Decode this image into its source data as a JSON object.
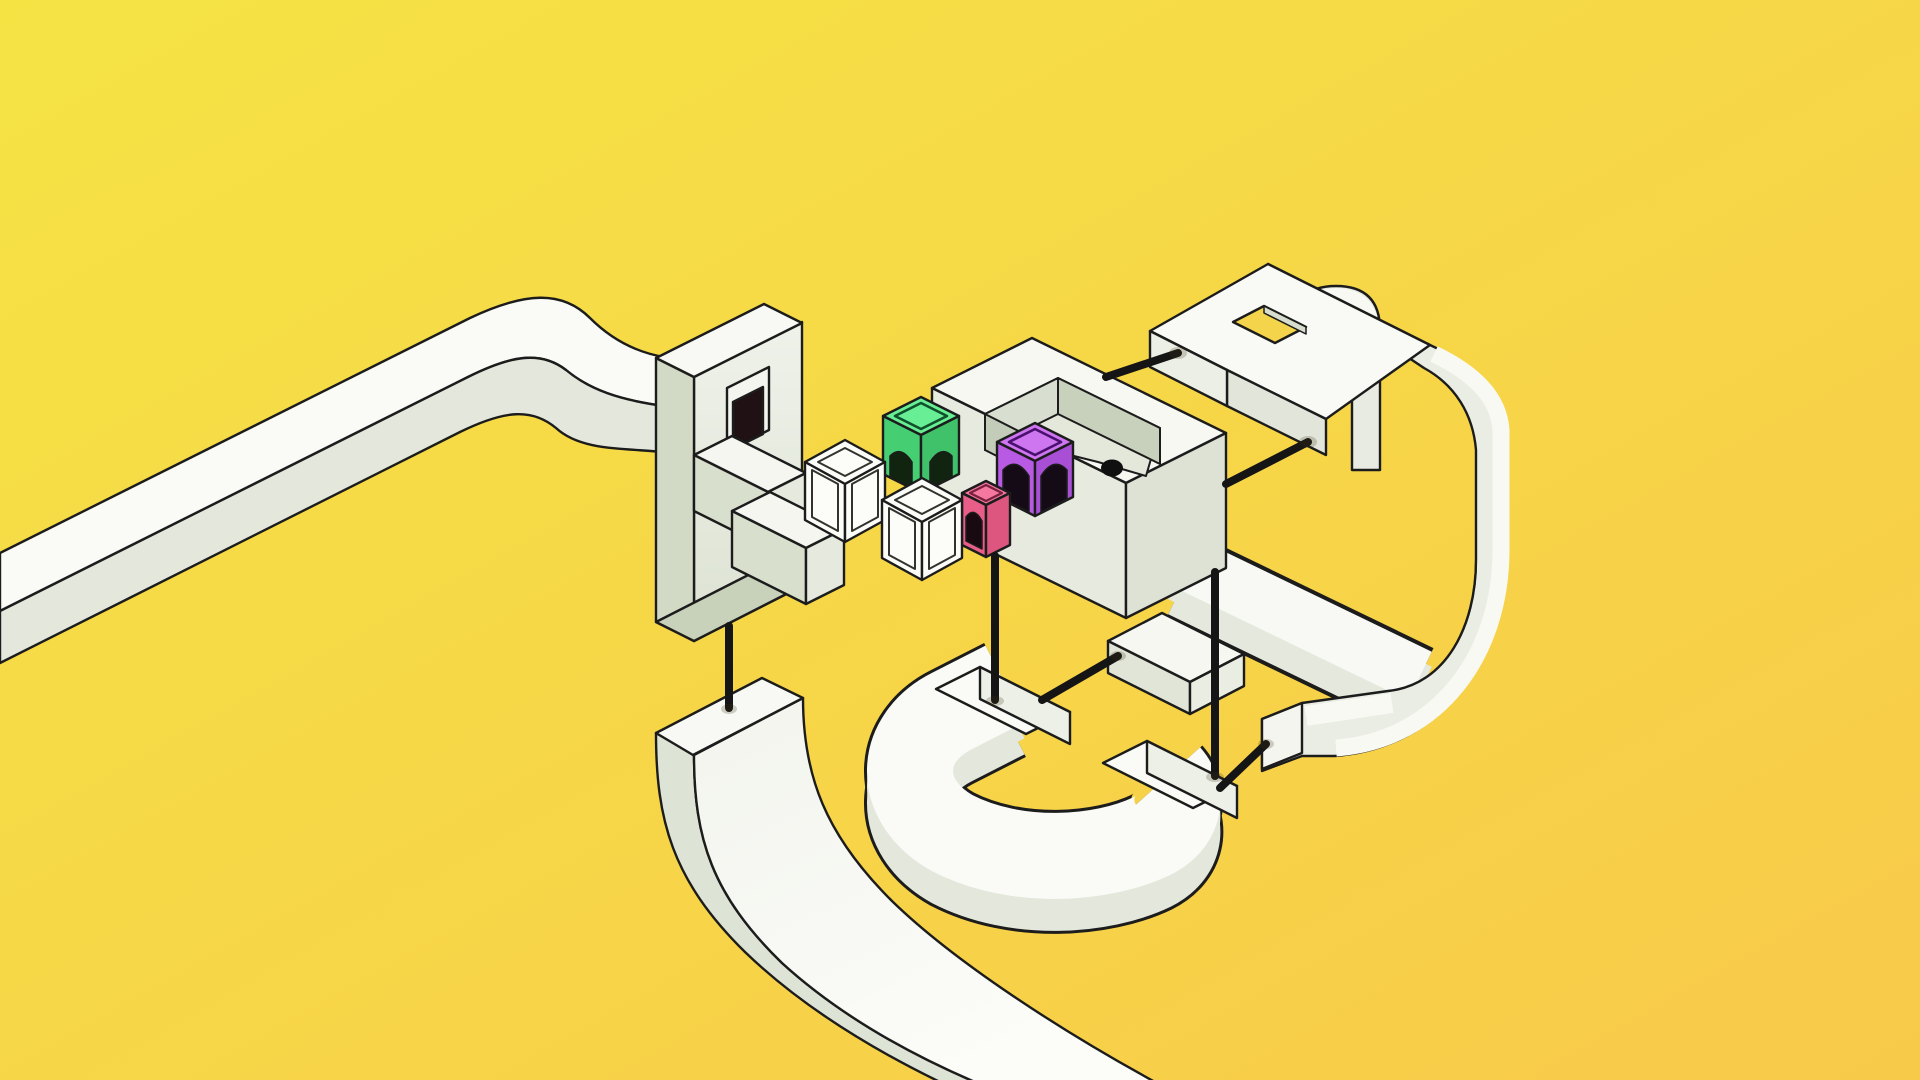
{
  "app": {
    "name": "isometric-puzzle-scene"
  },
  "scene": {
    "background": {
      "gradient_start": "#F5E344",
      "gradient_end": "#F8CA4A"
    },
    "palette": {
      "outline": "#1C1C1C",
      "rod": "#151515",
      "surface_top": "#FAFBF6",
      "surface_side": "#E4E8DC",
      "surface_side_dark": "#D2DAC6",
      "window_dark": "#1F1114",
      "ball": "#101010",
      "green_top": "#68EF95",
      "green_left": "#46CE72",
      "green_right": "#3FC26A",
      "purple_top": "#CE76F0",
      "purple_left": "#B85AE3",
      "purple_right": "#A94FD6",
      "pink_top": "#F478A0",
      "pink_left": "#E85E88",
      "pink_right": "#DD5680",
      "white_cube": "#FCFCF9"
    },
    "entities": {
      "ball": {
        "color": "#101010",
        "location": "tray-pocket"
      },
      "cubes": [
        {
          "id": "green-cube",
          "doors": 2
        },
        {
          "id": "purple-cube",
          "doors": 2
        },
        {
          "id": "pink-cube",
          "doors": 1
        },
        {
          "id": "white-frame-cube-1",
          "doors": 0
        },
        {
          "id": "white-frame-cube-2",
          "doors": 0
        }
      ],
      "rods": {
        "count": 7,
        "color": "#151515"
      },
      "structures": [
        "curved-track-left",
        "window-slab",
        "staircase",
        "tray-platform",
        "arch-bridge",
        "ribbon-loop-right",
        "connector-arm",
        "horseshoe-track",
        "connector-stub",
        "ramp-track"
      ]
    }
  }
}
